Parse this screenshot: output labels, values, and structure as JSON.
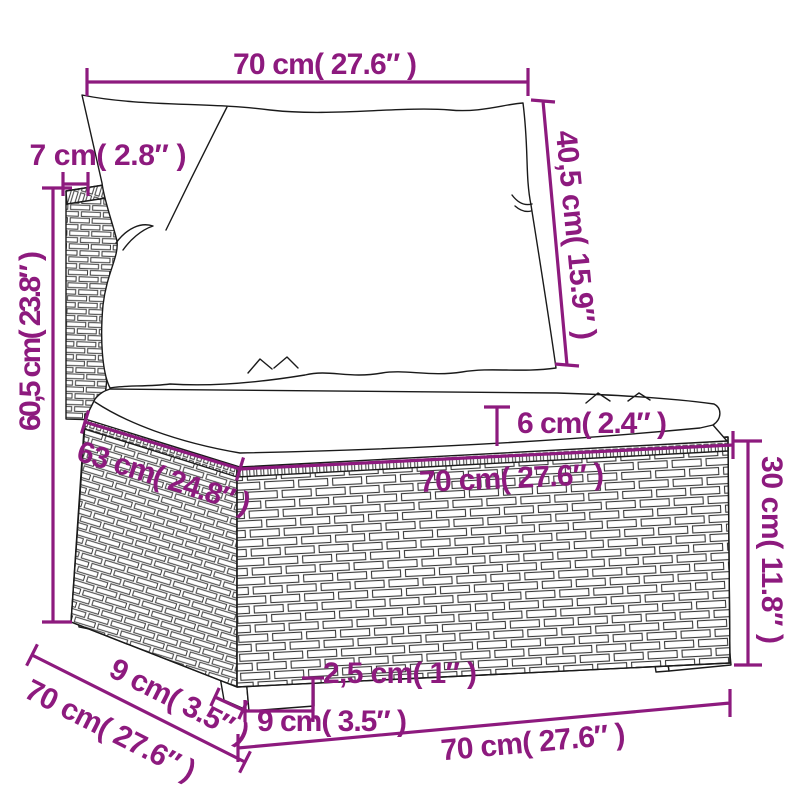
{
  "colors": {
    "dimension": "#8d1a7e",
    "outline": "#1a1a1a",
    "background": "#ffffff"
  },
  "labels": {
    "back_width": "70 cm( 27.6″ )",
    "back_cushion_height": "40,5 cm( 15.9″ )",
    "back_frame_thickness": "7 cm( 2.8″ )",
    "total_back_height": "60,5 cm( 23.8″ )",
    "seat_depth": "63 cm( 24.8″ )",
    "seat_cushion_thickness": "6 cm( 2.4″ )",
    "seat_width": "70 cm( 27.6″ )",
    "base_height": "30 cm( 11.8″ )",
    "overall_depth": "70 cm( 27.6″ )",
    "leg_depth": "9 cm( 3.5″ )",
    "leg_height": "2,5 cm( 1″ )",
    "leg_width": "9 cm( 3.5″ )",
    "overall_width": "70 cm( 27.6″ )"
  }
}
